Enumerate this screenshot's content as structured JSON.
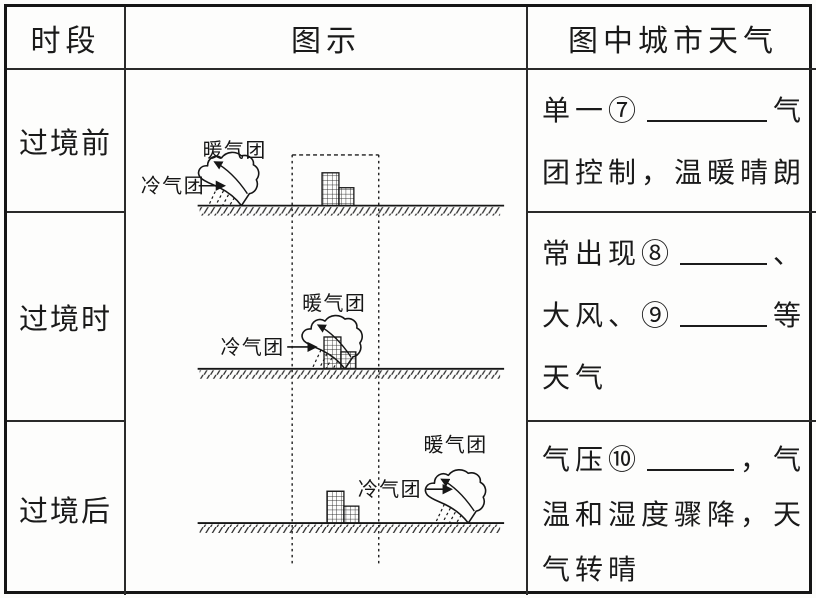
{
  "table": {
    "headers": {
      "period": "时段",
      "diagram": "图示",
      "weather": "图中城市天气"
    }
  },
  "rows": [
    {
      "period": "过境前",
      "diagram": {
        "warm": "暖气团",
        "cold": "冷气团"
      },
      "weather": [
        {
          "s0": "单一⑦",
          "s1": "气"
        },
        {
          "s0": "团控制，温暖晴朗"
        }
      ]
    },
    {
      "period": "过境时",
      "diagram": {
        "warm": "暖气团",
        "cold": "冷气团"
      },
      "weather": [
        {
          "s0": "常出现⑧",
          "s1": "、"
        },
        {
          "s0": "大风、⑨",
          "s1": "等"
        },
        {
          "s0": "天气"
        }
      ]
    },
    {
      "period": "过境后",
      "diagram": {
        "warm": "暖气团",
        "cold": "冷气团"
      },
      "weather": [
        {
          "s0": "气压⑩",
          "s1": "，气"
        },
        {
          "s0": "温和湿度骤降，天"
        },
        {
          "s0": "气转晴"
        }
      ]
    }
  ],
  "colors": {
    "ink": "#1a1a1a",
    "paper": "#fdfdfc"
  }
}
